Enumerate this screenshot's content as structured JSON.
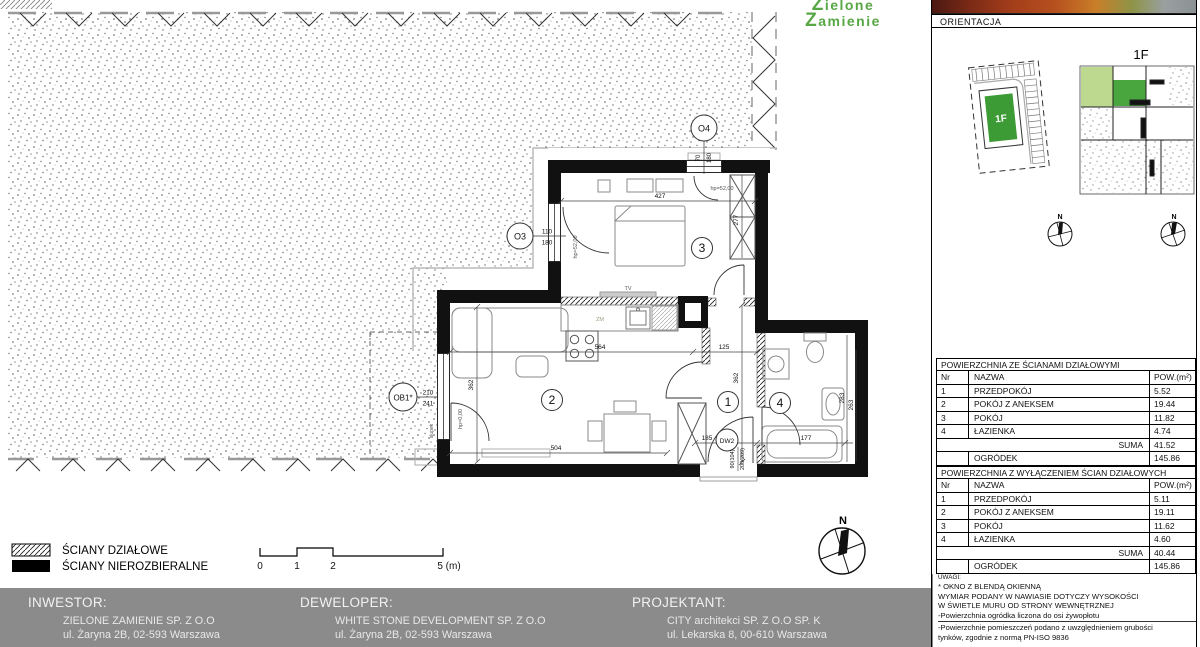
{
  "logo": {
    "line1": "Zielone",
    "line2": "Zamienie"
  },
  "colors": {
    "logo_green": "#57A845",
    "unit_green": "#3D9B35",
    "garden_green": "#BCD98F",
    "footer_gray": "#8B8B8B"
  },
  "plan": {
    "room_numbers": {
      "hall": "1",
      "living": "2",
      "bedroom": "3",
      "bath": "4"
    },
    "dims": {
      "bedroom_width": "427",
      "wardrobe": "277",
      "living_width": "564",
      "hall_width": "125",
      "living_depth": "362",
      "hall_depth": "362",
      "living_bottom": "504",
      "tub": "177",
      "bath_a": "283",
      "bath_b": "263",
      "entry": "185"
    },
    "markers": {
      "w03": "O3",
      "w03_w": "110",
      "w03_h": "180",
      "w04": "O4",
      "w04_w": "70",
      "w04_h": "180",
      "wb1": "OB1*",
      "wb1_w": "210",
      "wb1_h": "241",
      "door": "DW2",
      "door_w": "90(104)",
      "door_h": "200(209)"
    },
    "notes": {
      "sill03": "hp=52,00",
      "sill04": "hp=52,00",
      "sill_b1": "hp=0,00",
      "post": "słupek",
      "tv": "TV",
      "zm": "ZM"
    },
    "north": "N"
  },
  "legend": {
    "partition": "ŚCIANY DZIAŁOWE",
    "structural": "ŚCIANY NIEROZBIERALNE"
  },
  "scale": {
    "t0": "0",
    "t1": "1",
    "t2": "2",
    "t5": "5 (m)"
  },
  "panel": {
    "orientation": "ORIENTACJA",
    "site_unit": "1F",
    "key_unit": "1F",
    "north_left": "N",
    "north_right": "N",
    "table1": {
      "title": "POWIERZCHNIA ZE ŚCIANAMI DZIAŁOWYMI",
      "nr": "Nr",
      "name": "NAZWA",
      "pow": "POW.(m²)",
      "rows": [
        [
          "1",
          "PRZEDPOKÓJ",
          "5.52"
        ],
        [
          "2",
          "POKÓJ Z ANEKSEM",
          "19.44"
        ],
        [
          "3",
          "POKÓJ",
          "11.82"
        ],
        [
          "4",
          "ŁAZIENKA",
          "4.74"
        ]
      ],
      "suma_label": "SUMA",
      "suma": "41.52",
      "ogrodek_label": "OGRÓDEK",
      "ogrodek": "145.86"
    },
    "table2": {
      "title": "POWIERZCHNIA Z WYŁĄCZENIEM ŚCIAN DZIAŁOWYCH",
      "nr": "Nr",
      "name": "NAZWA",
      "pow": "POW.(m²)",
      "rows": [
        [
          "1",
          "PRZEDPOKÓJ",
          "5.11"
        ],
        [
          "2",
          "POKÓJ Z ANEKSEM",
          "19.11"
        ],
        [
          "3",
          "POKÓJ",
          "11.62"
        ],
        [
          "4",
          "ŁAZIENKA",
          "4.60"
        ]
      ],
      "suma_label": "SUMA",
      "suma": "40.44",
      "ogrodek_label": "OGRÓDEK",
      "ogrodek": "145.86"
    },
    "notes": [
      "UWAGI:",
      "* OKNO Z BLENDĄ OKIENNĄ",
      "WYMIAR PODANY W NAWIASIE DOTYCZY WYSOKOŚCI",
      "W ŚWIETLE MURU OD STRONY WEWNĘTRZNEJ",
      "-Powierzchnia ogródka liczona do osi żywopłotu",
      "-Powierzchnie pomieszczeń podano z uwzględnieniem grubości",
      "tynków, zgodnie z normą PN-ISO 9836"
    ]
  },
  "footer": {
    "inwestor_label": "INWESTOR:",
    "inwestor_name": "ZIELONE ZAMIENIE SP. Z O.O",
    "inwestor_addr": "ul. Żaryna 2B, 02-593 Warszawa",
    "deweloper_label": "DEWELOPER:",
    "deweloper_name": "WHITE STONE DEVELOPMENT SP. Z O.O",
    "deweloper_addr": "ul. Żaryna 2B, 02-593 Warszawa",
    "projektant_label": "PROJEKTANT:",
    "projektant_name": "CITY architekci SP. Z O.O SP. K",
    "projektant_addr": "ul. Lekarska 8, 00-610 Warszawa"
  }
}
